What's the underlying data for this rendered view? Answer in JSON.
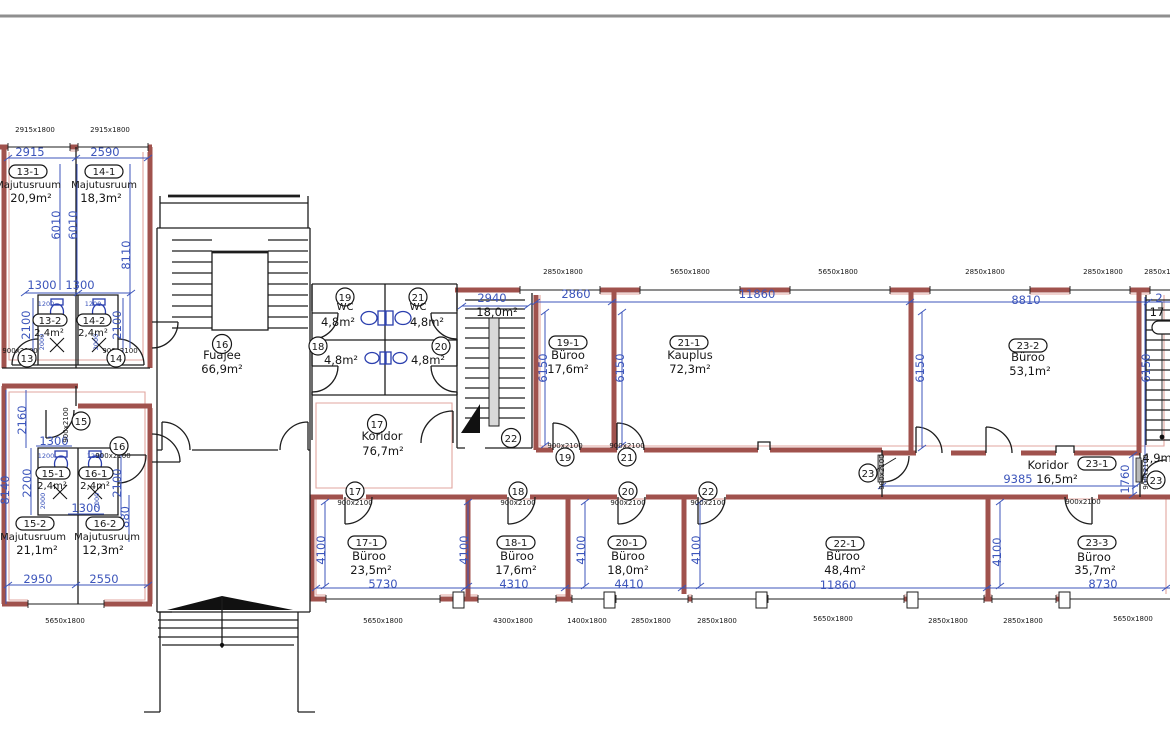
{
  "drawing_type": "floor-plan",
  "language": "Estonian",
  "colors": {
    "wall_accent": "#a0524d",
    "fire_outline": "#e2a59f",
    "dimension_blue": "#3c55bb",
    "fixture_blue": "#2b3fae",
    "line_black": "#1d1d1d",
    "top_border_gray": "#8f8f8f"
  },
  "rooms": {
    "r13_1": {
      "id": "13-1",
      "name": "Majutusruum",
      "area": "20,9m²"
    },
    "r14_1": {
      "id": "14-1",
      "name": "Majutusruum",
      "area": "18,3m²"
    },
    "r13_2": {
      "id": "13-2",
      "area": "2,4m²"
    },
    "r14_2": {
      "id": "14-2",
      "area": "2,4m²"
    },
    "r15_1": {
      "id": "15-1",
      "area": "2,4m²"
    },
    "r16_1": {
      "id": "16-1",
      "area": "2,4m²"
    },
    "r15_2": {
      "id": "15-2",
      "name": "Majutusruum",
      "area": "21,1m²"
    },
    "r16_2": {
      "id": "16-2",
      "name": "Majutusruum",
      "area": "12,3m²"
    },
    "r16": {
      "id": "16",
      "name": "Fuajee",
      "area": "66,9m²"
    },
    "r17": {
      "id": "17",
      "name": "Koridor",
      "area": "76,7m²"
    },
    "r19": {
      "id": "19",
      "name": "WC",
      "area": "4,8m²"
    },
    "r21": {
      "id": "21",
      "name": "WC",
      "area": "4,8m²"
    },
    "r18": {
      "id": "18",
      "area": "4,8m²"
    },
    "r20": {
      "id": "20",
      "area": "4,8m²"
    },
    "r22": {
      "id": "22",
      "area": "18,0m²"
    },
    "r19_1": {
      "id": "19-1",
      "name": "Büroo",
      "area": "17,6m²"
    },
    "r21_1": {
      "id": "21-1",
      "name": "Kauplus",
      "area": "72,3m²"
    },
    "r23_2": {
      "id": "23-2",
      "name": "Büroo",
      "area": "53,1m²"
    },
    "r23_1": {
      "id": "23-1",
      "name": "Koridor",
      "area": "16,5m²"
    },
    "closet": {
      "area": "4,9m"
    },
    "r17_1": {
      "id": "17-1",
      "name": "Büroo",
      "area": "23,5m²"
    },
    "r18_1": {
      "id": "18-1",
      "name": "Büroo",
      "area": "17,6m²"
    },
    "r20_1": {
      "id": "20-1",
      "name": "Büroo",
      "area": "18,0m²"
    },
    "r22_1": {
      "id": "22-1",
      "name": "Büroo",
      "area": "48,4m²"
    },
    "r23_3": {
      "id": "23-3",
      "name": "Büroo",
      "area": "35,7m²"
    }
  },
  "tags": {
    "t13": "13",
    "t14": "14",
    "t15": "15",
    "t16": "16",
    "t17": "17",
    "t18": "18",
    "t19": "19",
    "t20": "20",
    "t21": "21",
    "t22": "22",
    "t23": "23"
  },
  "openings": {
    "door_std": "900x2100",
    "win_2915": "2915x1800",
    "win_2850": "2850x1800",
    "win_5650": "5650x1800",
    "win_4300": "4300x1800",
    "win_1400": "1400x1800"
  },
  "dims": {
    "d2915": "2915",
    "d2590": "2590",
    "d6010": "6010",
    "d8110": "8110",
    "d1300": "1300",
    "d2100": "2100",
    "d1200": "1200",
    "d2000": "2000",
    "d2160": "2160",
    "d2200": "2200",
    "d8140": "8140",
    "d880": "880",
    "d2950": "2950",
    "d2550": "2550",
    "d2860": "2860",
    "d11860": "11860",
    "d8810": "8810",
    "d6150": "6150",
    "d2940": "2940",
    "d9385": "9385",
    "d1760": "1760",
    "d4100": "4100",
    "d5730": "5730",
    "d4310": "4310",
    "d4410": "4410",
    "d8730": "8730",
    "partial_w": "2",
    "partial_a": "17"
  }
}
